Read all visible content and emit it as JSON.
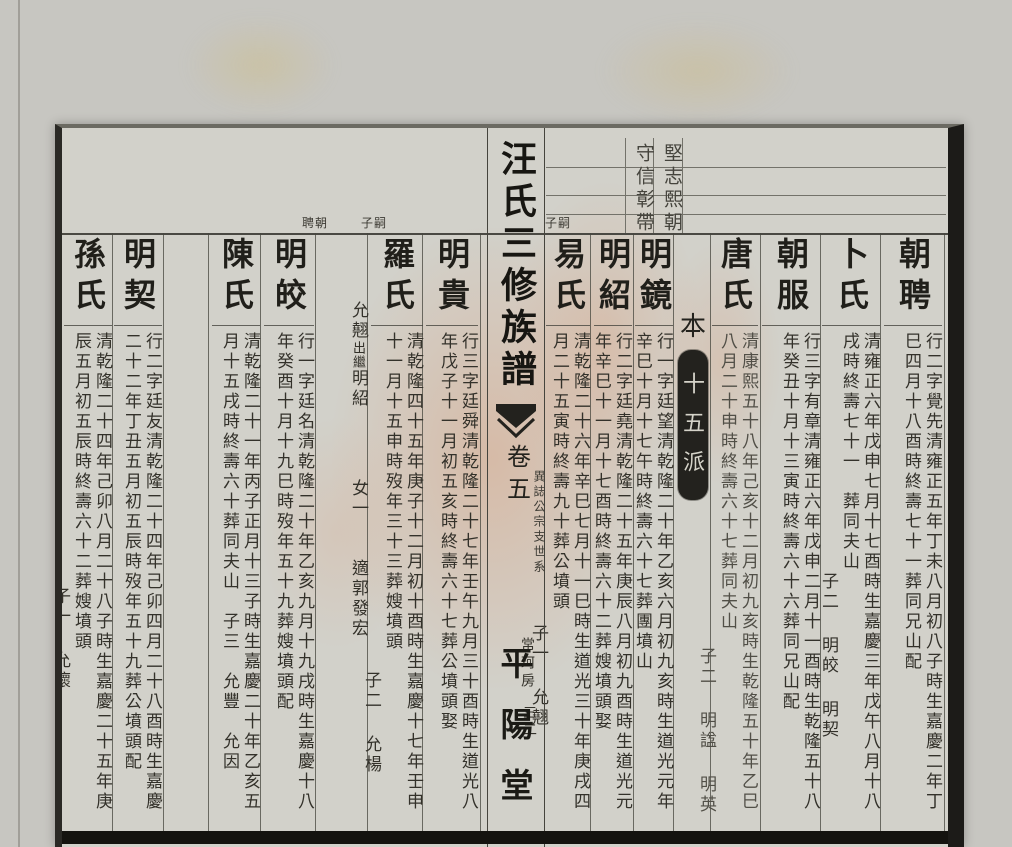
{
  "header": {
    "generation_motto_right": "堅志熙朝",
    "generation_motto_left": "守信彰帶",
    "label_heir_right": "嗣子",
    "label_heir_left": "嗣子",
    "label_father": "朝聘"
  },
  "spine": {
    "title": "汪氏三修族譜",
    "volume": "卷五",
    "lineage": "異誌公宗支世系",
    "branch": "常珂房",
    "page_number": "三二",
    "hall": "平陽堂"
  },
  "generation_marker": {
    "prefix": "本",
    "seal": "十五派"
  },
  "colors": {
    "paper": "#d2d1ca",
    "ink": "#2b2a25",
    "seal_background": "#23221e",
    "stain_pink": "#de9670",
    "border_black": "#1c1b18"
  },
  "entries": [
    {
      "name": "朝聘",
      "cols": [
        "行二字覺先清雍正五年丁未八月初八子時生嘉慶二年丁",
        "巳四月十八酉時終壽七十一葬同兄山配"
      ]
    },
    {
      "name": "卜氏",
      "cols": [
        "清雍正六年戊申七月十七酉時生嘉慶三年戊午八月十八",
        "戌時終壽七十一　葬同夫山"
      ],
      "issue": {
        "label": "子二",
        "names": [
          "明皎",
          "明契"
        ]
      }
    },
    {
      "name": "朝服",
      "cols": [
        "行三字有章清雍正六年戊申二月十一酉時生乾隆五十八",
        "年癸丑十月十三寅時終壽六十六葬同兄山配"
      ]
    },
    {
      "name": "唐氏",
      "cols": [
        "清康熙五十八年己亥十二月初九亥時生乾隆五十年乙巳",
        "八月二十申時終壽六十七葬同夫山"
      ],
      "issue": {
        "label": "子二",
        "names": [
          "明諡",
          "明英"
        ]
      }
    },
    {
      "name": "明鏡",
      "cols": [
        "行一字廷望清乾隆二十年乙亥六月初九亥時生道光元年",
        "辛巳十月十七午時終壽六十七葬團墳山"
      ]
    },
    {
      "name": "明紹",
      "cols": [
        "行二字廷堯清乾隆二十五年庚辰八月初九酉時生道光元",
        "年辛巳十一月十七酉時終壽六十二葬嫂墳頭娶"
      ]
    },
    {
      "name": "易氏",
      "cols": [
        "清乾隆二十六年辛巳七月十一巳時生道光三十年庚戌四",
        "月二十五寅時終壽九十葬公墳頭"
      ],
      "issue": {
        "label": "子一",
        "names": [
          "允翹"
        ]
      }
    },
    {
      "name": "明貴",
      "cols": [
        "行三字廷舜清乾隆二十七年壬午九月三十酉時生道光八",
        "年戊子十一月初五亥時終壽六十七葬公墳頭娶"
      ]
    },
    {
      "name": "羅氏",
      "cols": [
        "清乾隆四十五年庚子十二月初十酉時生嘉慶十七年壬申",
        "十一月十五申時歿年三十三葬嫂墳頭"
      ],
      "issue": {
        "label": "子二",
        "names": [
          "允楊"
        ]
      }
    },
    {
      "name": "",
      "note_head": "允翹",
      "note_small": "出繼",
      "note_tail": "明紹",
      "daughter": "女一",
      "daughter_marriage": "適郭發宏"
    },
    {
      "name": "明皎",
      "cols": [
        "行一字廷名清乾隆二十年乙亥九月十九戌時生嘉慶十八",
        "年癸酉十月十九巳時歿年五十九葬嫂墳頭配"
      ]
    },
    {
      "name": "陳氏",
      "cols": [
        "清乾隆二十一年丙子正月十三子時生嘉慶二十年乙亥五",
        "月十五戌時終壽六十葬同夫山　子三　允豐　允因"
      ]
    },
    {
      "name": "明契",
      "cols": [
        "行二字廷友清乾隆二十四年己卯四月二十八酉時生嘉慶",
        "二十二年丁丑五月初五辰時歿年五十九葬公墳頭配"
      ]
    },
    {
      "name": "孫氏",
      "cols": [
        "清乾隆二十四年己卯八月二十八子時生嘉慶二十五年庚",
        "辰五月初五辰時終壽六十二葬嫂墳頭"
      ],
      "issue": {
        "label": "子一",
        "names": [
          "允懷"
        ]
      }
    }
  ]
}
